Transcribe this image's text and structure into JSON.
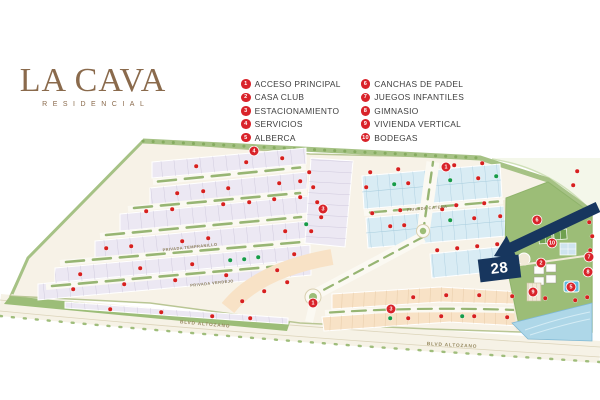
{
  "logo": {
    "title": "LA CAVA",
    "subtitle": "RESIDENCIAL"
  },
  "legend": {
    "items": [
      {
        "num": "1",
        "label": "ACCESO PRINCIPAL",
        "col": 1
      },
      {
        "num": "2",
        "label": "CASA CLUB",
        "col": 1
      },
      {
        "num": "3",
        "label": "ESTACIONAMIENTO",
        "col": 1
      },
      {
        "num": "4",
        "label": "SERVICIOS",
        "col": 1
      },
      {
        "num": "5",
        "label": "ALBERCA",
        "col": 1
      },
      {
        "num": "6",
        "label": "CANCHAS DE PADEL",
        "col": 2
      },
      {
        "num": "7",
        "label": "JUEGOS INFANTILES",
        "col": 2
      },
      {
        "num": "8",
        "label": "GIMNASIO",
        "col": 2
      },
      {
        "num": "9",
        "label": "VIVIENDA VERTICAL",
        "col": 2
      },
      {
        "num": "10",
        "label": "BODEGAS",
        "col": 2
      }
    ]
  },
  "map": {
    "highlight_lot": "28",
    "street_labels": [
      {
        "text": "PRIVADA TEMPRANILLO",
        "x": 190,
        "y": 247,
        "rot": -6,
        "kind": "privada"
      },
      {
        "text": "PRIVADA CATENA",
        "x": 427,
        "y": 208,
        "rot": -5,
        "kind": "privada"
      },
      {
        "text": "PRIVADA VERDEJO",
        "x": 212,
        "y": 283,
        "rot": -6,
        "kind": "privada"
      },
      {
        "text": "BLVD ALTOZANO",
        "x": 205,
        "y": 325,
        "rot": 5,
        "kind": "blvd"
      },
      {
        "text": "BLVD ALTOZANO",
        "x": 452,
        "y": 346,
        "rot": 3,
        "kind": "blvd"
      }
    ],
    "badges": [
      {
        "n": "1",
        "x": 313,
        "y": 303
      },
      {
        "n": "3",
        "x": 323,
        "y": 209
      },
      {
        "n": "4",
        "x": 254,
        "y": 151
      },
      {
        "n": "1",
        "x": 446,
        "y": 167
      },
      {
        "n": "6",
        "x": 537,
        "y": 220
      },
      {
        "n": "10",
        "x": 552,
        "y": 243
      },
      {
        "n": "2",
        "x": 541,
        "y": 263
      },
      {
        "n": "9",
        "x": 533,
        "y": 292
      },
      {
        "n": "5",
        "x": 571,
        "y": 287
      },
      {
        "n": "7",
        "x": 589,
        "y": 257
      },
      {
        "n": "8",
        "x": 588,
        "y": 272
      },
      {
        "n": "3",
        "x": 391,
        "y": 309
      }
    ],
    "lot_dots": {
      "red": [
        [
          196,
          166
        ],
        [
          246,
          162
        ],
        [
          282,
          158
        ],
        [
          177,
          193
        ],
        [
          203,
          191
        ],
        [
          228,
          188
        ],
        [
          279,
          183
        ],
        [
          300,
          181
        ],
        [
          146,
          211
        ],
        [
          172,
          209
        ],
        [
          223,
          204
        ],
        [
          249,
          202
        ],
        [
          274,
          199
        ],
        [
          300,
          197
        ],
        [
          106,
          248
        ],
        [
          131,
          246
        ],
        [
          182,
          241
        ],
        [
          208,
          238
        ],
        [
          285,
          231
        ],
        [
          80,
          274
        ],
        [
          140,
          268
        ],
        [
          192,
          264
        ],
        [
          294,
          254
        ],
        [
          73,
          289
        ],
        [
          124,
          284
        ],
        [
          175,
          280
        ],
        [
          226,
          275
        ],
        [
          277,
          270
        ],
        [
          110,
          309
        ],
        [
          161,
          312
        ],
        [
          212,
          316
        ],
        [
          250,
          318
        ],
        [
          309,
          172
        ],
        [
          313,
          187
        ],
        [
          317,
          202
        ],
        [
          321,
          217
        ],
        [
          311,
          231
        ],
        [
          370,
          172
        ],
        [
          398,
          169
        ],
        [
          446,
          168
        ],
        [
          454,
          165
        ],
        [
          482,
          163
        ],
        [
          366,
          187
        ],
        [
          408,
          183
        ],
        [
          478,
          178
        ],
        [
          372,
          213
        ],
        [
          400,
          210
        ],
        [
          442,
          209
        ],
        [
          456,
          205
        ],
        [
          484,
          203
        ],
        [
          390,
          226
        ],
        [
          404,
          225
        ],
        [
          474,
          218
        ],
        [
          500,
          216
        ],
        [
          437,
          250
        ],
        [
          457,
          248
        ],
        [
          477,
          246
        ],
        [
          497,
          244
        ],
        [
          577,
          171
        ],
        [
          573,
          185
        ],
        [
          589,
          222
        ],
        [
          592,
          236
        ],
        [
          590,
          250
        ],
        [
          242,
          301
        ],
        [
          264,
          291
        ],
        [
          287,
          282
        ],
        [
          413,
          297
        ],
        [
          446,
          295
        ],
        [
          479,
          295
        ],
        [
          512,
          296
        ],
        [
          545,
          298
        ],
        [
          575,
          300
        ],
        [
          587,
          297
        ],
        [
          408,
          318
        ],
        [
          441,
          316
        ],
        [
          474,
          316
        ],
        [
          507,
          317
        ]
      ],
      "green": [
        [
          230,
          260
        ],
        [
          244,
          259
        ],
        [
          258,
          257
        ],
        [
          306,
          224
        ],
        [
          394,
          184
        ],
        [
          450,
          180
        ],
        [
          496,
          176
        ],
        [
          450,
          220
        ],
        [
          390,
          318
        ],
        [
          462,
          316
        ]
      ]
    },
    "colors": {
      "brand_brown": "#8a6a4c",
      "badge_red": "#d9232a",
      "marker_red": "#d7201f",
      "marker_green": "#179c49",
      "highlight_navy": "#17365e",
      "water_blue": "#aed7e8"
    }
  }
}
